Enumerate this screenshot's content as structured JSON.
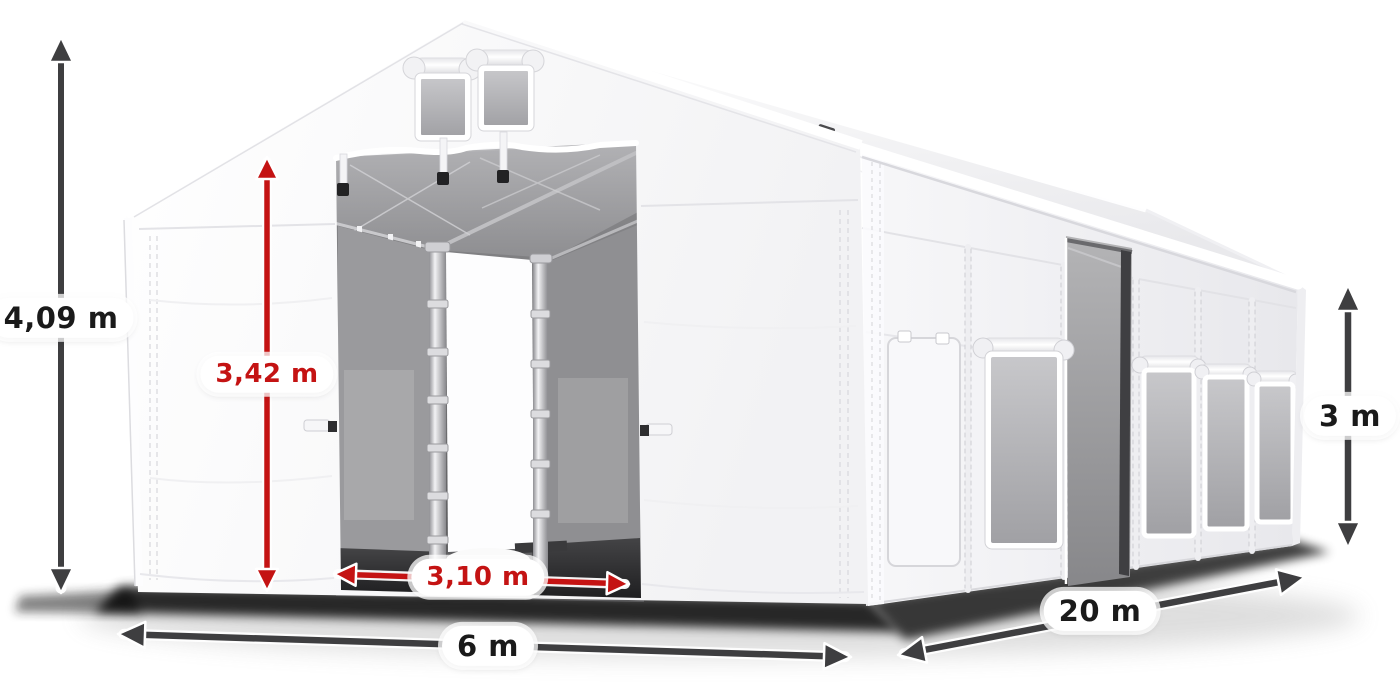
{
  "colors": {
    "red": "#c41313",
    "dark": "#3e3e40",
    "label": "#1a1a1a",
    "pill": "#ffffff"
  },
  "diagram": {
    "type": "product-dimension-diagram",
    "subject": "White PVC storage tent with gable roof, two gable vents, open double front doors and mesh side windows",
    "dimensions": {
      "total_height": {
        "label": "4,09 m"
      },
      "clearance_height": {
        "label": "3,42 m"
      },
      "door_width": {
        "label": "3,10 m"
      },
      "front_width": {
        "label": "6 m"
      },
      "side_length": {
        "label": "20 m"
      },
      "wall_height": {
        "label": "3 m"
      }
    }
  }
}
